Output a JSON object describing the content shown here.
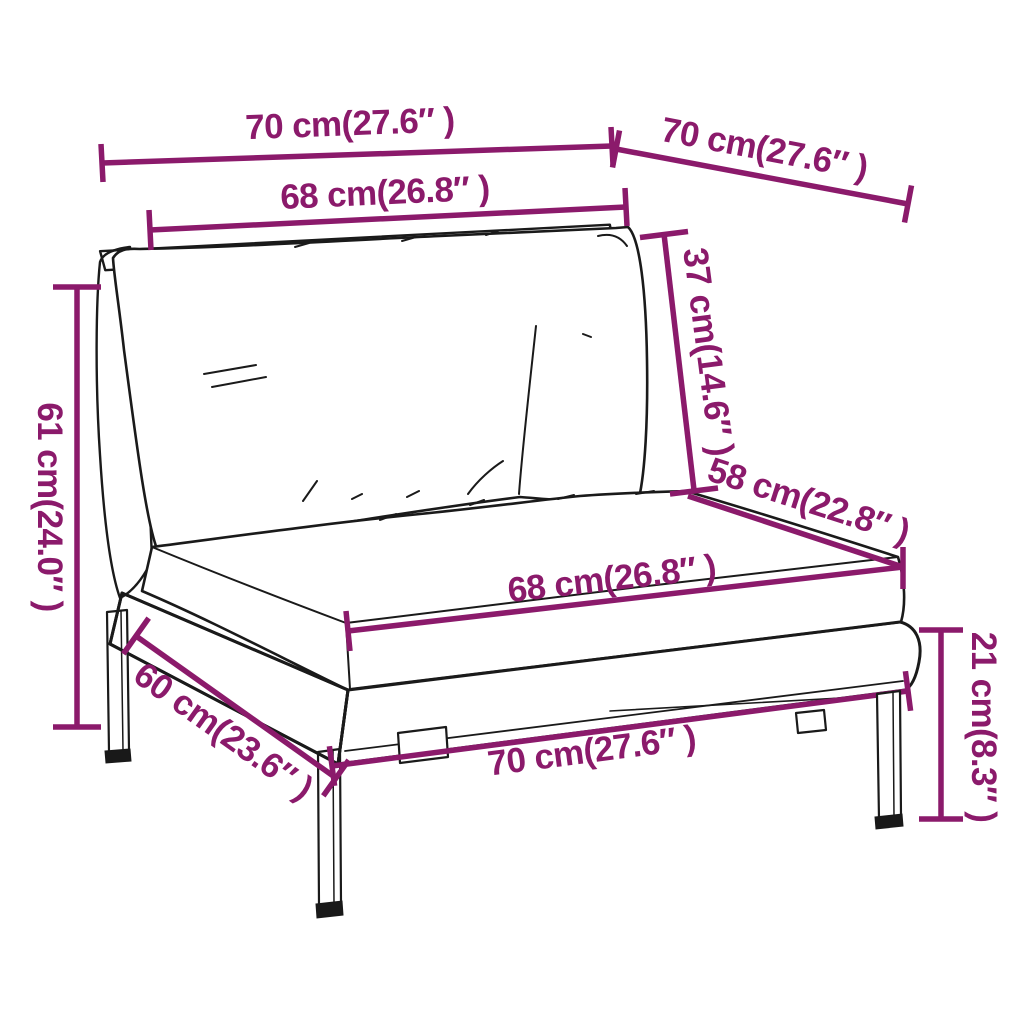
{
  "diagram": {
    "background": "#ffffff",
    "accent_color": "#8B1A6B",
    "line_color": "#1a1a1a",
    "figure": "half-round poly rattan garden sofa middle section with back and seat cushions, 3/4 line-art view",
    "dimensions": [
      {
        "id": "top-width",
        "label": "70 cm(27.6″ )",
        "cm": 70,
        "inch": 27.6
      },
      {
        "id": "top-depth",
        "label": "70 cm(27.6″ )",
        "cm": 70,
        "inch": 27.6
      },
      {
        "id": "backrest-width",
        "label": "68 cm(26.8″ )",
        "cm": 68,
        "inch": 26.8
      },
      {
        "id": "back-cushion-height",
        "label": "37 cm(14.6″ )",
        "cm": 37,
        "inch": 14.6
      },
      {
        "id": "overall-height",
        "label": "61 cm(24.0″ )",
        "cm": 61,
        "inch": 24.0
      },
      {
        "id": "seat-depth",
        "label": "58 cm(22.8″ )",
        "cm": 58,
        "inch": 22.8
      },
      {
        "id": "seat-cushion-width",
        "label": "68 cm(26.8″ )",
        "cm": 68,
        "inch": 26.8
      },
      {
        "id": "base-depth",
        "label": "60 cm(23.6″ )",
        "cm": 60,
        "inch": 23.6
      },
      {
        "id": "base-front-width",
        "label": "70 cm(27.6″ )",
        "cm": 70,
        "inch": 27.6
      },
      {
        "id": "leg-base-height",
        "label": "21 cm(8.3″ )",
        "cm": 21,
        "inch": 8.3
      }
    ]
  }
}
